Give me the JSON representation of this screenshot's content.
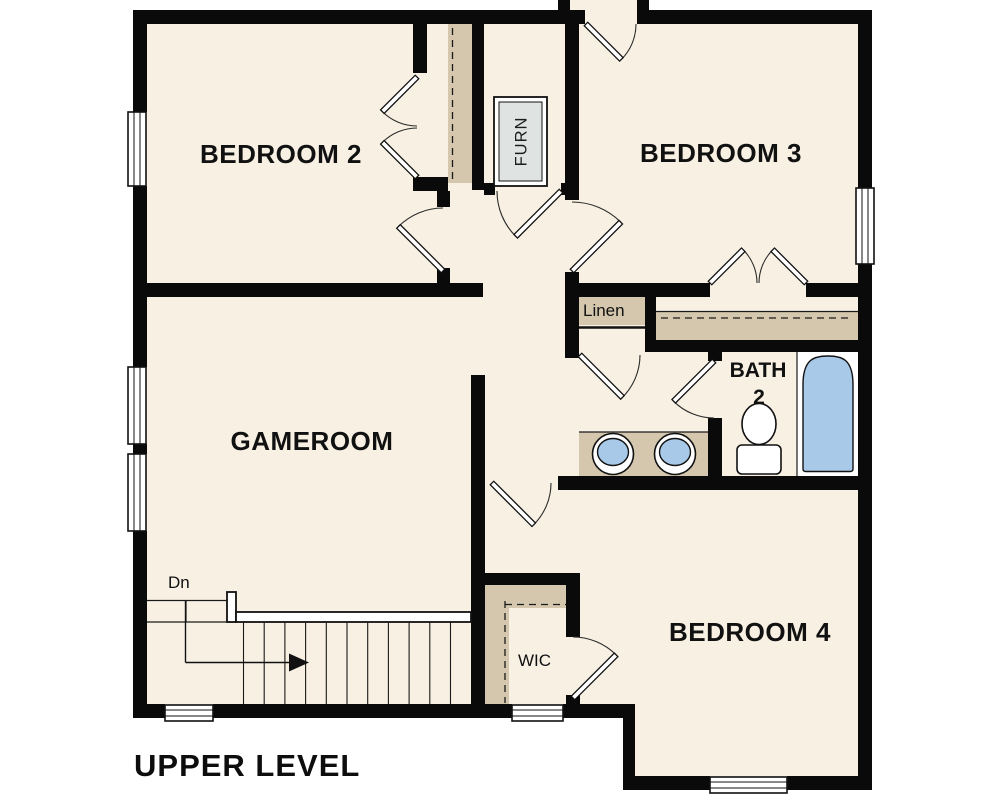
{
  "title": "UPPER LEVEL",
  "rooms": {
    "bedroom2": {
      "label": "BEDROOM 2"
    },
    "bedroom3": {
      "label": "BEDROOM 3"
    },
    "bedroom4": {
      "label": "BEDROOM 4"
    },
    "gameroom": {
      "label": "GAMEROOM"
    },
    "bath2": {
      "label_line1": "BATH",
      "label_line2": "2"
    },
    "linen_closet": {
      "label": "Linen"
    },
    "walk_in_closet": {
      "label": "WIC"
    },
    "furnace_closet": {
      "label": "FURN"
    }
  },
  "stairs": {
    "direction_label": "Dn"
  },
  "fixtures": [
    "bathtub",
    "toilet",
    "sink-left",
    "sink-right"
  ],
  "colors": {
    "background": "#ffffff",
    "floor": "#f7f0e3",
    "millwork": "#d4c7ad",
    "wall": "#0a0a0a",
    "fixture_blue": "#a9c9e9",
    "furnace_gray": "#dfe3e2"
  }
}
